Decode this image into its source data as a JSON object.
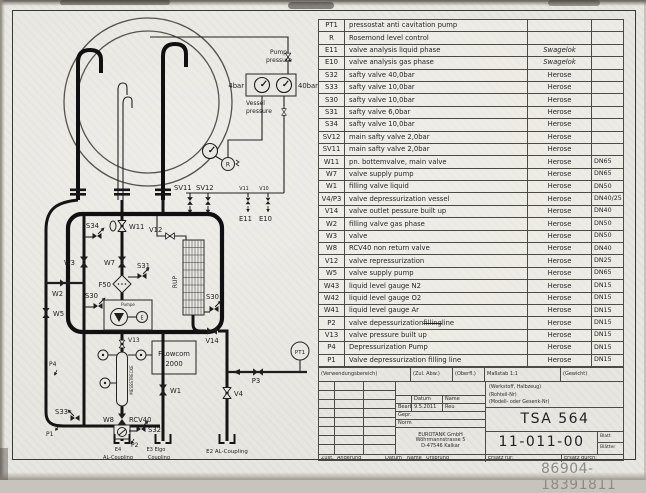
{
  "document": {
    "watermark": "86904-18391811"
  },
  "parts_table": {
    "rows": [
      {
        "id": "PT1",
        "desc": "pressostat anti cavitation pump",
        "mfr": "",
        "size": ""
      },
      {
        "id": "R",
        "desc": "Rosemond level control",
        "mfr": "",
        "size": ""
      },
      {
        "id": "E11",
        "desc": "valve analysis liquid phase",
        "mfr": "Swagelok",
        "size": ""
      },
      {
        "id": "E10",
        "desc": "valve analysis gas phase",
        "mfr": "Swagelok",
        "size": ""
      },
      {
        "id": "S32",
        "desc": "safty valve 40,0bar",
        "mfr": "Herose",
        "size": ""
      },
      {
        "id": "S33",
        "desc": "safty valve 10,0bar",
        "mfr": "Herose",
        "size": ""
      },
      {
        "id": "S30",
        "desc": "safty valve 10,0bar",
        "mfr": "Herose",
        "size": ""
      },
      {
        "id": "S31",
        "desc": "safty valve 6,0bar",
        "mfr": "Herose",
        "size": ""
      },
      {
        "id": "S34",
        "desc": "safty valve 10,0bar",
        "mfr": "Herose",
        "size": ""
      },
      {
        "id": "SV12",
        "desc": "main safty valve 2,0bar",
        "mfr": "Herose",
        "size": ""
      },
      {
        "id": "SV11",
        "desc": "main safty valve 2,0bar",
        "mfr": "Herose",
        "size": ""
      },
      {
        "id": "W11",
        "desc": "pn. bottemvalve, main valve",
        "mfr": "Herose",
        "size": "DN65"
      },
      {
        "id": "W7",
        "desc": "valve supply pump",
        "mfr": "Herose",
        "size": "DN65"
      },
      {
        "id": "W1",
        "desc": "filling valve liquid",
        "mfr": "Herose",
        "size": "DN50"
      },
      {
        "id": "V4/P3",
        "desc": "valve depressurization vessel",
        "mfr": "Herose",
        "size": "DN40/25"
      },
      {
        "id": "V14",
        "desc": "valve outlet pessure built up",
        "mfr": "Herose",
        "size": "DN40"
      },
      {
        "id": "W2",
        "desc": "filling valve gas phase",
        "mfr": "Herose",
        "size": "DN50"
      },
      {
        "id": "W3",
        "desc": "valve",
        "mfr": "Herose",
        "size": "DN50"
      },
      {
        "id": "W8",
        "desc": "RCV40 non return valve",
        "mfr": "Herose",
        "size": "DN40"
      },
      {
        "id": "V12",
        "desc": "valve repressurization",
        "mfr": "Herose",
        "size": "DN25"
      },
      {
        "id": "W5",
        "desc": "valve supply pump",
        "mfr": "Herose",
        "size": "DN65"
      },
      {
        "id": "W43",
        "desc": "liquid level gauge N2",
        "mfr": "Herose",
        "size": "DN15"
      },
      {
        "id": "W42",
        "desc": "liquid level gauge O2",
        "mfr": "Herose",
        "size": "DN15"
      },
      {
        "id": "W41",
        "desc": "liquid level gauge Ar",
        "mfr": "Herose",
        "size": "DN15"
      },
      {
        "id": "P2",
        "desc": "valve depessurization",
        "strike": "filling",
        "post": "line",
        "mfr": "Herose",
        "size": "DN15"
      },
      {
        "id": "V13",
        "desc": "valve pressure built up",
        "mfr": "Herose",
        "size": "DN15"
      },
      {
        "id": "P4",
        "desc": "Depressurization Pump",
        "mfr": "Herose",
        "size": "DN15"
      },
      {
        "id": "P1",
        "desc": "Valve depressurization filling line",
        "mfr": "Herose",
        "size": "DN15"
      }
    ]
  },
  "title_block": {
    "verwendungsbereich": "(Verwendungsbereich)",
    "zul_abw": "(Zul. Abw.)",
    "oberfl": "(Oberfl.)",
    "massstab": "Maßstab 1:1",
    "gewicht": "(Gewicht)",
    "werkstoff": "(Werkstoff, Halbzeug)",
    "rohteil": "(Rohteil-Nr)",
    "modell": "(Modell- oder Gesenk-Nr)",
    "datum": "Datum",
    "name": "Name",
    "bearb": "Bearb.",
    "bearb_datum": "9.5.2011",
    "bearb_name": "Reu",
    "gepr": "Gepr.",
    "norm": "Norm",
    "company_1": "EUROTANK GmbH",
    "company_2": "Wöhrmannstrasse 5",
    "company_3": "D-47546 Kalkar",
    "part_no": "TSA 564",
    "drawing_no": "11-011-00",
    "blatt": "Blatt",
    "blaetter": "Blätter",
    "zust": "Zust.",
    "aenderung": "Änderung",
    "datum2": "Datum",
    "name2": "Name",
    "ursprung": "Ursprung",
    "ersatz_fuer": "Ersatz für:",
    "ersatz_durch": "Ersatz durch:"
  },
  "diagram": {
    "labels": {
      "pump_l1": "Pump",
      "pump_l2": "pressure",
      "bar4": "4bar",
      "bar40": "40bar",
      "vessel_l1": "Vessel",
      "vessel_l2": "pressure",
      "r": "R",
      "sv11": "SV11",
      "sv12": "SV12",
      "v11": "V11",
      "v10": "V10",
      "e11": "E11",
      "e10": "E10",
      "s34": "S34",
      "w11": "W11",
      "v12": "V12",
      "w3": "W3",
      "w7": "W7",
      "s31": "S31",
      "f50": "F50",
      "w2": "W2",
      "s30a": "S30",
      "s30b": "S30",
      "w5": "W5",
      "rup": "RUP",
      "pumpe": "Pumpe",
      "motor_e": "E",
      "v13": "V13",
      "mess": "MESSSTRECKE",
      "flow1": "FLowcom",
      "flow2": "2000",
      "w1": "W1",
      "s33": "S33",
      "p1": "P1",
      "p4": "P4",
      "w8": "W8",
      "rcv40": "RCV40",
      "s32": "S32",
      "p2": "P2",
      "v14": "V14",
      "p3": "P3",
      "v4": "V4",
      "pt1": "PT1",
      "e3a": "E3 Elgo",
      "e3b": "Coupling",
      "e4a": "E4",
      "e4b": "AL-Coupling",
      "e2": "E2 AL-Coupling"
    }
  }
}
